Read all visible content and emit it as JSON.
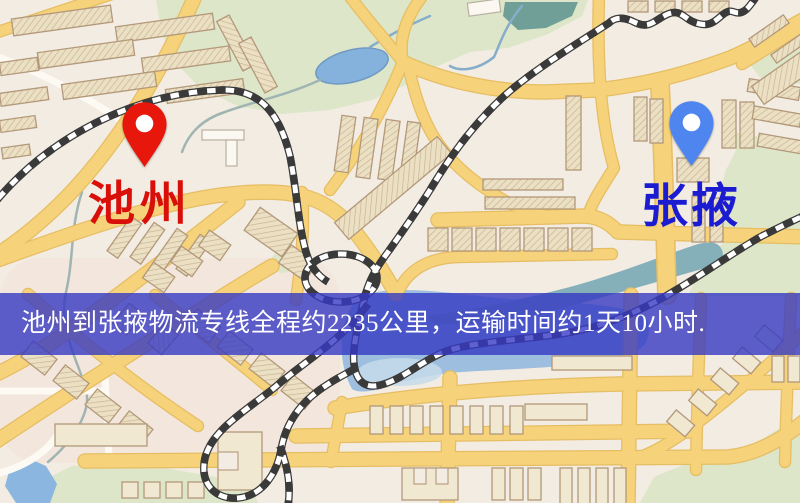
{
  "banner": {
    "text": "池州到张掖物流专线全程约2235公里，运输时间约1天10小时."
  },
  "origin": {
    "label": "池州"
  },
  "destination": {
    "label": "张掖"
  },
  "palette": {
    "map-bg": "#f2ece2",
    "road-fill": "#f6d37b",
    "road-edge": "#e6bd62",
    "park": "#dde6c8",
    "park-dark": "#c9d8ae",
    "water": "#9dbede",
    "water-light": "#c6dcea",
    "river-teal": "#85b0ba",
    "river-dark": "#6f9f96",
    "rail-dark": "#3a3a3a",
    "building-edge": "#b3987a",
    "banner-bg": "rgba(54,57,195,0.8)",
    "banner-text": "#ffffff",
    "origin-pin": "#e8170b",
    "origin-label": "#d90f0a",
    "destination-pin": "#4f85ef",
    "destination-label": "#1b1bd1"
  }
}
